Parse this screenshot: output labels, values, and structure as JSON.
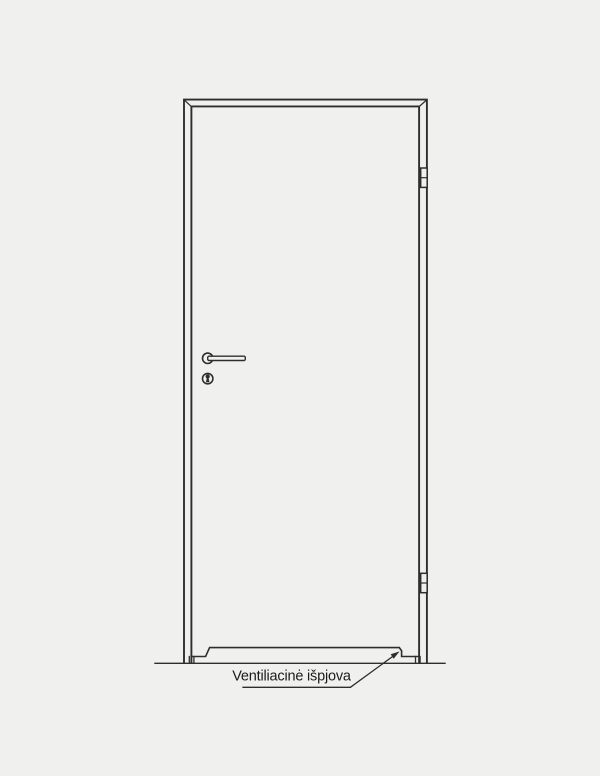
{
  "diagram": {
    "type": "technical-drawing",
    "annotation": {
      "label": "Ventiliacinė išpjova"
    },
    "colors": {
      "background": "#f0f0ee",
      "line": "#2e2e2e",
      "text": "#1b1b1b"
    }
  }
}
